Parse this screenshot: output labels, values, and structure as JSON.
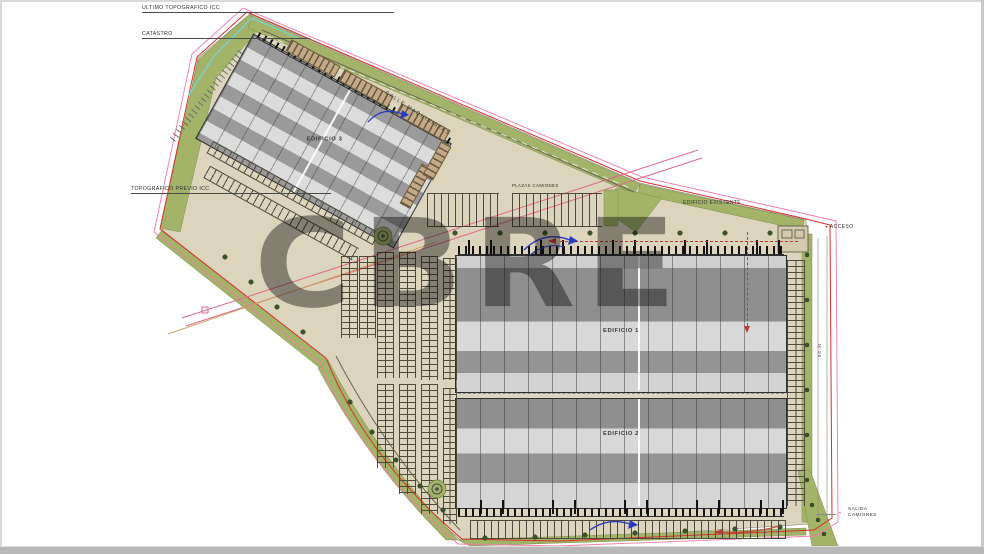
{
  "watermark": {
    "text": "CBRE"
  },
  "annotations": {
    "ultimo_topografico": "ULTIMO TOPOGRAFICO ICC",
    "catastro": "CATASTRO",
    "topografico_previo": "TOPOGRAFICO PREVIO ICC",
    "calle_maquinistas": "CALLE MAQUINISTAS",
    "edificio_existente": "EDIFICIO EXISTENTE",
    "plazas_camiones": "PLAZAS CAMIONES",
    "acceso": "ACCESO",
    "salida_camiones": "SALIDA CAMIONES",
    "road_vertical": "M-50"
  },
  "icons": {
    "acceso_arrow": "◄",
    "salida_marker": "▪"
  },
  "buildings": [
    {
      "label": "EDIFICIO 1"
    },
    {
      "label": "EDIFICIO 2"
    },
    {
      "label": "EDIFICIO 3"
    }
  ],
  "colors": {
    "pad_beige": "#dcd4bc",
    "landscape_green": "#a3b469",
    "building_dark": "#8f8f8f",
    "building_light": "#d8d8d8",
    "boundary_red": "#d62f2f",
    "boundary_magenta": "#f07ba8",
    "boundary_cyan": "#72d4de",
    "powerline_pink": "#e06a88",
    "truck_template_blue": "#2a3bc0",
    "tree_green": "#3c5328",
    "watermark_gray": "rgba(10,10,10,0.42)"
  }
}
